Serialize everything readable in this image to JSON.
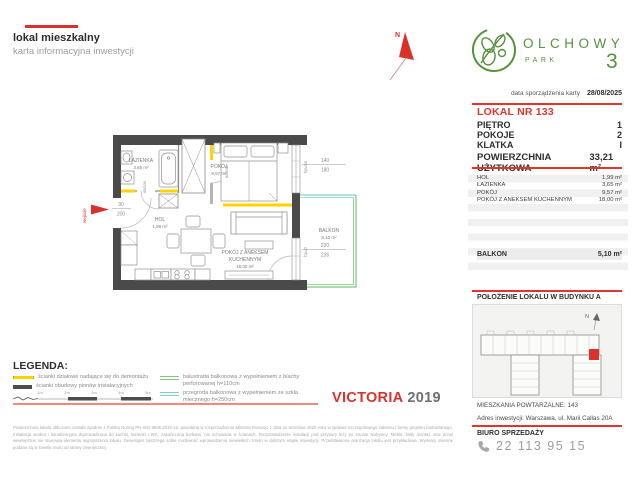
{
  "header": {
    "doc_title": "lokal mieszkalny",
    "doc_subtitle": "karta informacyjna inwestycji"
  },
  "logo": {
    "line1": "OLCHOWY",
    "line2": "PARK",
    "number": "3"
  },
  "panel": {
    "date_label": "data sporządzenia karty",
    "date_value": "28/08/2025",
    "unit_no": "LOKAL NR 133",
    "attrs": [
      {
        "label": "PIĘTRO",
        "value": "1"
      },
      {
        "label": "POKOJE",
        "value": "2"
      },
      {
        "label": "KLATKA",
        "value": "I"
      }
    ],
    "area_label": "POWIERZCHNIA UŻYTKOWA",
    "area_value": "33,21 m²",
    "rooms": [
      {
        "label": "HOL",
        "value": "1,99 m²"
      },
      {
        "label": "ŁAZIENKA",
        "value": "3,65 m²"
      },
      {
        "label": "POKÓJ",
        "value": "9,57 m²"
      },
      {
        "label": "POKÓJ Z ANEKSEM KUCHENNYM",
        "value": "18,00 m²"
      }
    ],
    "balcony_label": "BALKON",
    "balcony_value": "5,10 m²",
    "location_title": "POŁOŻENIE LOKALU W BUDYNKU A",
    "repeatable": "MIESZKANIA POWTARZALNE: 143",
    "address": "Adres inwestycji: Warszawa, ul. Marii Callas 20A",
    "office_label": "BIURO SPRZEDAŻY",
    "phone": "22 113 95 15"
  },
  "plan": {
    "north_letter": "N",
    "entrance_label": "wejście",
    "rooms": {
      "bathroom_name": "ŁAZIENKA",
      "bathroom_area": "3,65 m²",
      "bedroom_name": "POKÓJ",
      "bedroom_area": "9,57 m²",
      "hall_name": "HOL",
      "hall_area": "1,99 m²",
      "living_name1": "POKÓJ Z ANEKSEM",
      "living_name2": "KUCHENNYM",
      "living_area": "18,00 m²",
      "balcony_name": "BALKON",
      "balcony_area": "5,10 m²"
    },
    "dims": {
      "entry_w": "90",
      "entry_h": "200",
      "win1_w": "140",
      "win1_h": "180",
      "win1_sill": "hp=54",
      "win2_w": "220",
      "win2_h": "235",
      "win2_sill": "hp=0",
      "int_door1": "80/200",
      "int_door2": "80/200"
    }
  },
  "legend": {
    "title": "LEGENDA:",
    "item_yellow": "ścianki działowe nadające się do demontażu",
    "item_dark": "ścianki obudowy pionów instalacyjnych",
    "item_green": "balustrada balkonowa z wypełnieniem z blachy perforowanej h=110cm",
    "item_teal": "przegroda balkonowa z wypełnieniem ze szkła mlecznego h=250cm",
    "scale_ticks": [
      "1m",
      "2m",
      "3m",
      "4m",
      "5m"
    ]
  },
  "brand": {
    "name": "VICTORIA",
    "year": "2019"
  },
  "footnote": "Powierzchnia lokalu obliczona została zgodnie z Polską Normą PN-ISO 9836:2015-12, powołaną w rozporządzeniu Ministra Rozwoju z dnia 11 września 2020 roku w sprawie szczegółowego zakresu i formy projektu budowlanego. Instalacja wodna i kanalizacyjna doprowadzona do kuchni, łazienki i WC, zakończona korkami, nie schowana w ścianach. Rozprowadzenie instalacji pod przybory leży po stronie Nabywcy. Meble, biały montaż oraz drzwi wewnętrzne nie stanowią elementu wyposażenia lokalu. Deweloper zastrzega sobie możliwość wprowadzenia niewielkich zmian w dalszym etapie inwestycji. Przedstawiona aranżacja lokalu jest przykładowa. Wymiary okienne podane są w świetle muru od strony zewnętrznej.",
  "colors": {
    "accent_red": "#d9322a",
    "wall_gray": "#4a4a4a",
    "partition_yellow": "#ffd200",
    "balustrade_green": "#7cc87c",
    "divider_teal": "#82d2c3",
    "logo_green": "#55923c"
  }
}
